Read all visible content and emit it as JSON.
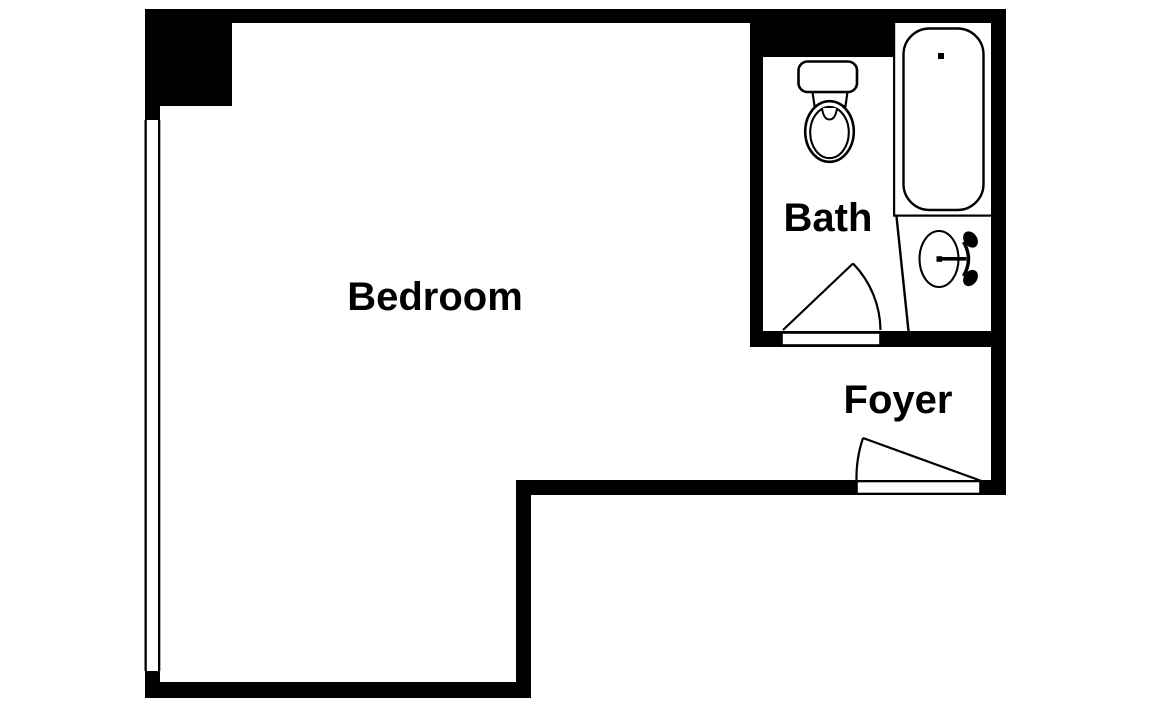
{
  "floorplan": {
    "background_color": "#ffffff",
    "wall_color": "#000000",
    "label_color": "#000000",
    "rooms": [
      {
        "id": "bedroom",
        "label": "Bedroom"
      },
      {
        "id": "bath",
        "label": "Bath"
      },
      {
        "id": "foyer",
        "label": "Foyer"
      }
    ],
    "fixtures": [
      {
        "id": "toilet",
        "room": "bath"
      },
      {
        "id": "bathtub",
        "room": "bath"
      },
      {
        "id": "sink",
        "room": "bath"
      }
    ],
    "doors": [
      {
        "id": "bath-door",
        "connects": "foyer-bath"
      },
      {
        "id": "entry-door",
        "connects": "foyer-entry"
      }
    ],
    "windows": [
      {
        "id": "bedroom-window",
        "wall": "left"
      }
    ]
  }
}
